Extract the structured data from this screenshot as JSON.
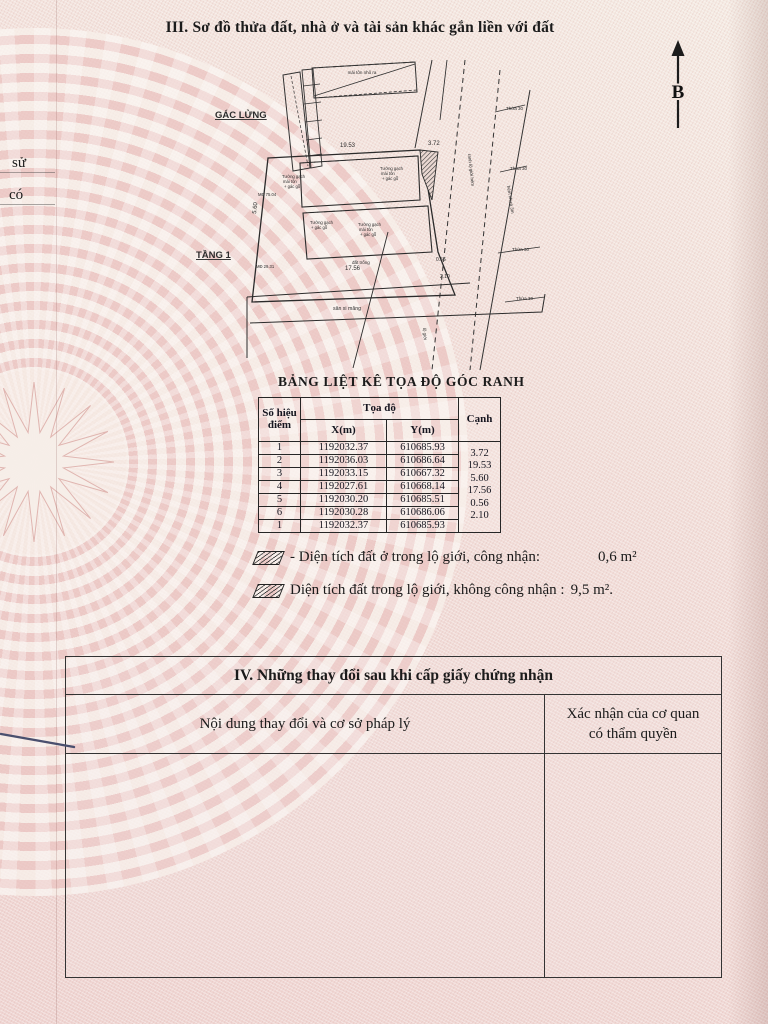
{
  "section3": {
    "title": "III. Sơ đồ thửa đất, nhà ở và tài sản khác gắn liền với đất"
  },
  "margin": {
    "frag1": "sử",
    "frag2": "có"
  },
  "compass": {
    "north": "B"
  },
  "diagram": {
    "gac_lung": "GÁC LỬNG",
    "tang1": "TẦNG 1",
    "roof_note": "mái tôn nhô ra",
    "note_line1": "Tường gạch",
    "note_line2": "mái tôn",
    "note_line3": "+ gác gỗ",
    "yard": "sân xi măng",
    "vacant": "đất trống",
    "road1": "ranh lộ giới hẻm",
    "road2": "hẻm nhựa 3m",
    "road3": "lộ giới",
    "lot": "Thửa 30",
    "tiny1": "MĐ 29.31",
    "tiny2": "MĐ 75.04",
    "dim_top": "19.53",
    "dim_right": "3.72",
    "dim_bottom": "17.56",
    "dim_left": "5.60",
    "dim_s1": "0.56",
    "dim_s2": "2.10"
  },
  "coord_table": {
    "title": "BẢNG LIỆT KÊ TỌA ĐỘ GÓC RANH",
    "col_point_1": "Số hiệu",
    "col_point_2": "điểm",
    "col_group": "Tọa độ",
    "col_x": "X(m)",
    "col_y": "Y(m)",
    "col_edge": "Cạnh",
    "rows": [
      {
        "point": "1",
        "x": "1192032.37",
        "y": "610685.93"
      },
      {
        "point": "2",
        "x": "1192036.03",
        "y": "610686.64"
      },
      {
        "point": "3",
        "x": "1192033.15",
        "y": "610667.32"
      },
      {
        "point": "4",
        "x": "1192027.61",
        "y": "610668.14"
      },
      {
        "point": "5",
        "x": "1192030.20",
        "y": "610685.51"
      },
      {
        "point": "6",
        "x": "1192030.28",
        "y": "610686.06"
      },
      {
        "point": "1",
        "x": "1192032.37",
        "y": "610685.93"
      }
    ],
    "edges": [
      "3.72",
      "19.53",
      "5.60",
      "17.56",
      "0.56",
      "2.10"
    ]
  },
  "legend": {
    "item1_text": "- Diện tích đất ở trong lộ giới, công nhận:",
    "item1_value": "0,6 m²",
    "item2_text": "Diện tích đất trong lộ giới, không công nhận :",
    "item2_value": "9,5 m²."
  },
  "section4": {
    "title": "IV. Những thay đổi sau khi cấp giấy chứng nhận",
    "col_left": "Nội dung thay đổi và cơ sở pháp lý",
    "col_right_1": "Xác nhận của cơ quan",
    "col_right_2": "có thẩm quyền"
  }
}
